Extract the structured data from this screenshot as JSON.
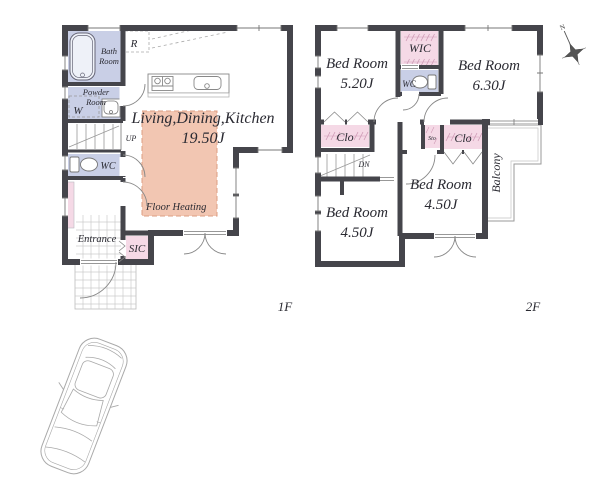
{
  "floor1": {
    "floor_label": "1F",
    "ldk": {
      "name": "Living,Dining,Kitchen",
      "size": "19.50J"
    },
    "floor_heating": "Floor Heating",
    "bath": {
      "l1": "Bath",
      "l2": "Room"
    },
    "powder": {
      "l1": "Powder",
      "l2": "Room"
    },
    "washer": "W",
    "fridge": "R",
    "wc": "WC",
    "up": "UP",
    "entrance": "Entrance",
    "sic": "SIC"
  },
  "floor2": {
    "floor_label": "2F",
    "bed1": {
      "name": "Bed Room",
      "size": "5.20J"
    },
    "bed2": {
      "name": "Bed Room",
      "size": "6.30J"
    },
    "bed3": {
      "name": "Bed Room",
      "size": "4.50J"
    },
    "bed4": {
      "name": "Bed Room",
      "size": "4.50J"
    },
    "wic": "WIC",
    "wc": "WC",
    "clo_left": "Clo",
    "clo_right": "Clo",
    "sto": "Sto",
    "dn": "DN",
    "balcony": "Balcony"
  },
  "compass": {
    "north": "N"
  },
  "colors": {
    "wall": "#45454b",
    "wet_room": "#c9cfe6",
    "closet_pink": "#f5d9e6",
    "floor_heating_fill": "#f2c6b2",
    "floor_heating_border": "#dc9d82",
    "tile_line": "#cccccc",
    "fixture_line": "#888888",
    "text": "#2a2a32"
  }
}
